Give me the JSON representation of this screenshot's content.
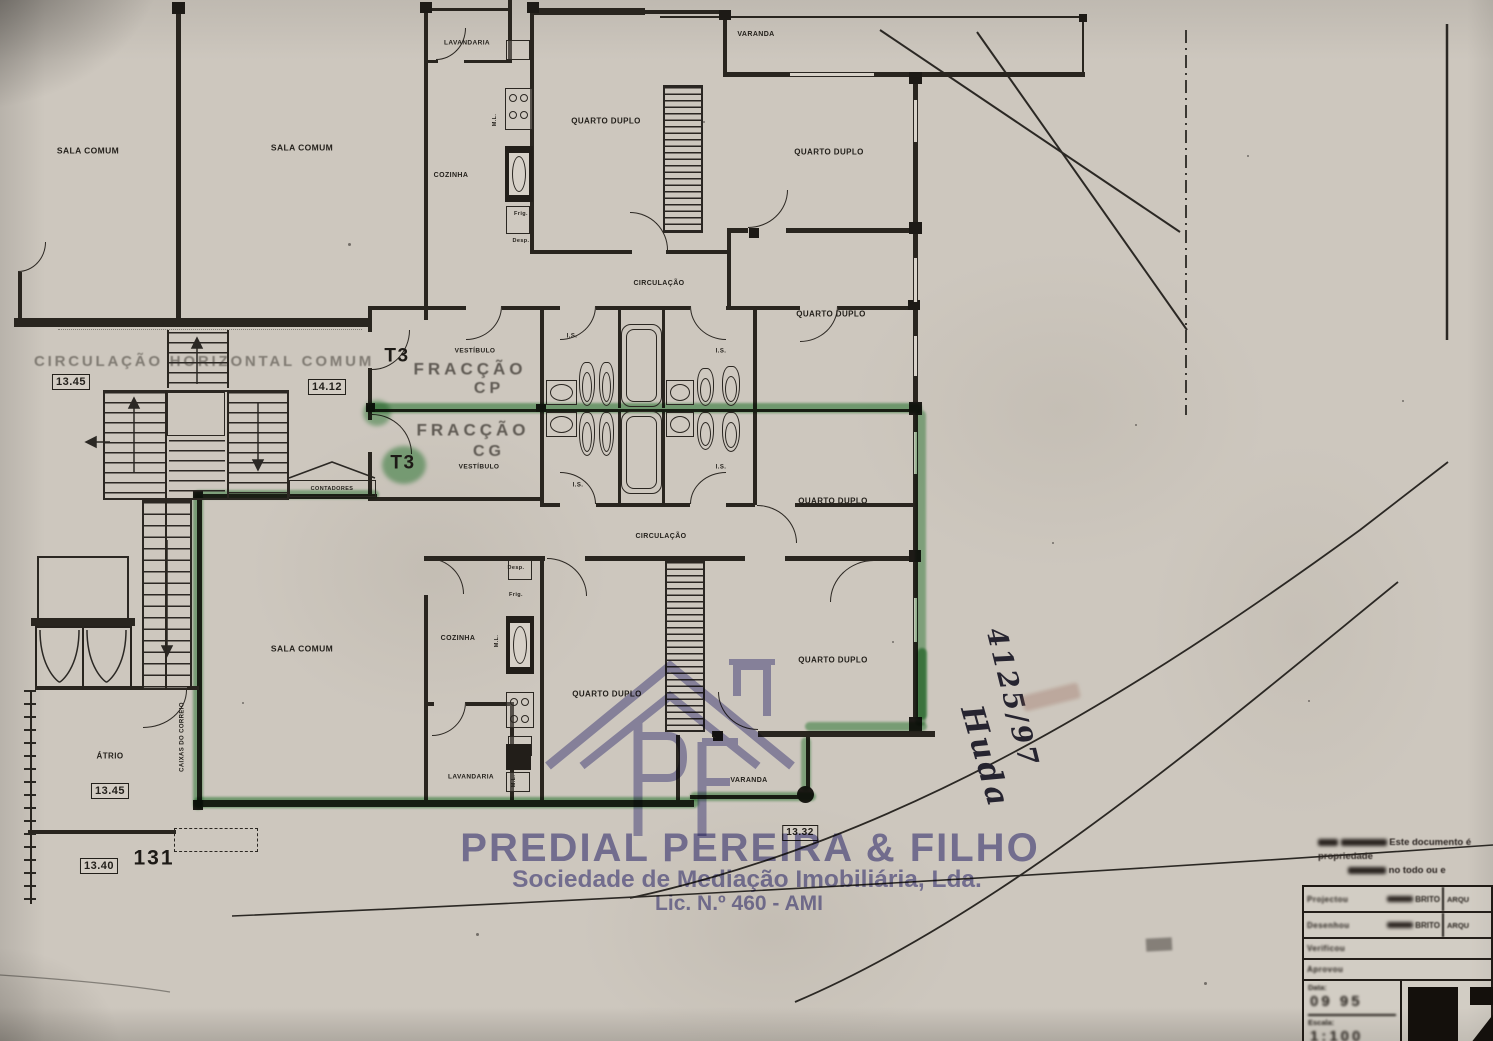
{
  "plan": {
    "room_labels": {
      "sala_comum": "SALA COMUM",
      "cozinha": "COZINHA",
      "lavandaria": "LAVANDARIA",
      "quarto_duplo": "QUARTO DUPLO",
      "varanda": "VARANDA",
      "circulacao": "CIRCULAÇÃO",
      "circulacao_horizontal": "CIRCULAÇÃO HORIZONTAL COMUM",
      "vestibulo": "VESTÍBULO",
      "atrio": "ÁTRIO",
      "is": "I.S.",
      "ml": "M.L.",
      "frig": "Frig.",
      "desp": "Desp.",
      "contadores": "CONTADORES",
      "caixas_correio": "CAIXAS DO CORREIO"
    },
    "fractions": {
      "cp": {
        "type": "T3",
        "name": "FRACÇÃO",
        "code": "CP"
      },
      "cg": {
        "type": "T3",
        "name": "FRACÇÃO",
        "code": "CG"
      }
    },
    "measurements": {
      "level_1345": "13.45",
      "level_1412": "14.12",
      "level_1340": "13.40",
      "level_1332": "13.32",
      "street_number": "131"
    },
    "highlight_color": "#3c9a4a"
  },
  "watermark": {
    "company": "PREDIAL PEREIRA & FILHO",
    "subtitle": "Sociedade de Mediação Imobiliária, Lda.",
    "license": "Lic. N.º 460 - AMI",
    "monogram": "PF",
    "color": "#7e7cb6"
  },
  "annotations": {
    "handwritten_ref": "4125/97",
    "handwritten_name": "Huda"
  },
  "title_block": {
    "notice_line1": "Este documento é propriedade",
    "notice_line2": "no todo ou e",
    "rows": [
      {
        "label": "Projectou",
        "name": "BRITO",
        "role": "ARQU"
      },
      {
        "label": "Desenhou",
        "name": "BRITO",
        "role": "ARQU"
      },
      {
        "label": "Verificou",
        "name": "",
        "role": ""
      },
      {
        "label": "Aprovou",
        "name": "",
        "role": ""
      }
    ],
    "data_label": "Data:",
    "data_value": "09 95",
    "scale_label": "Escala:",
    "scale_value": "1:100"
  }
}
